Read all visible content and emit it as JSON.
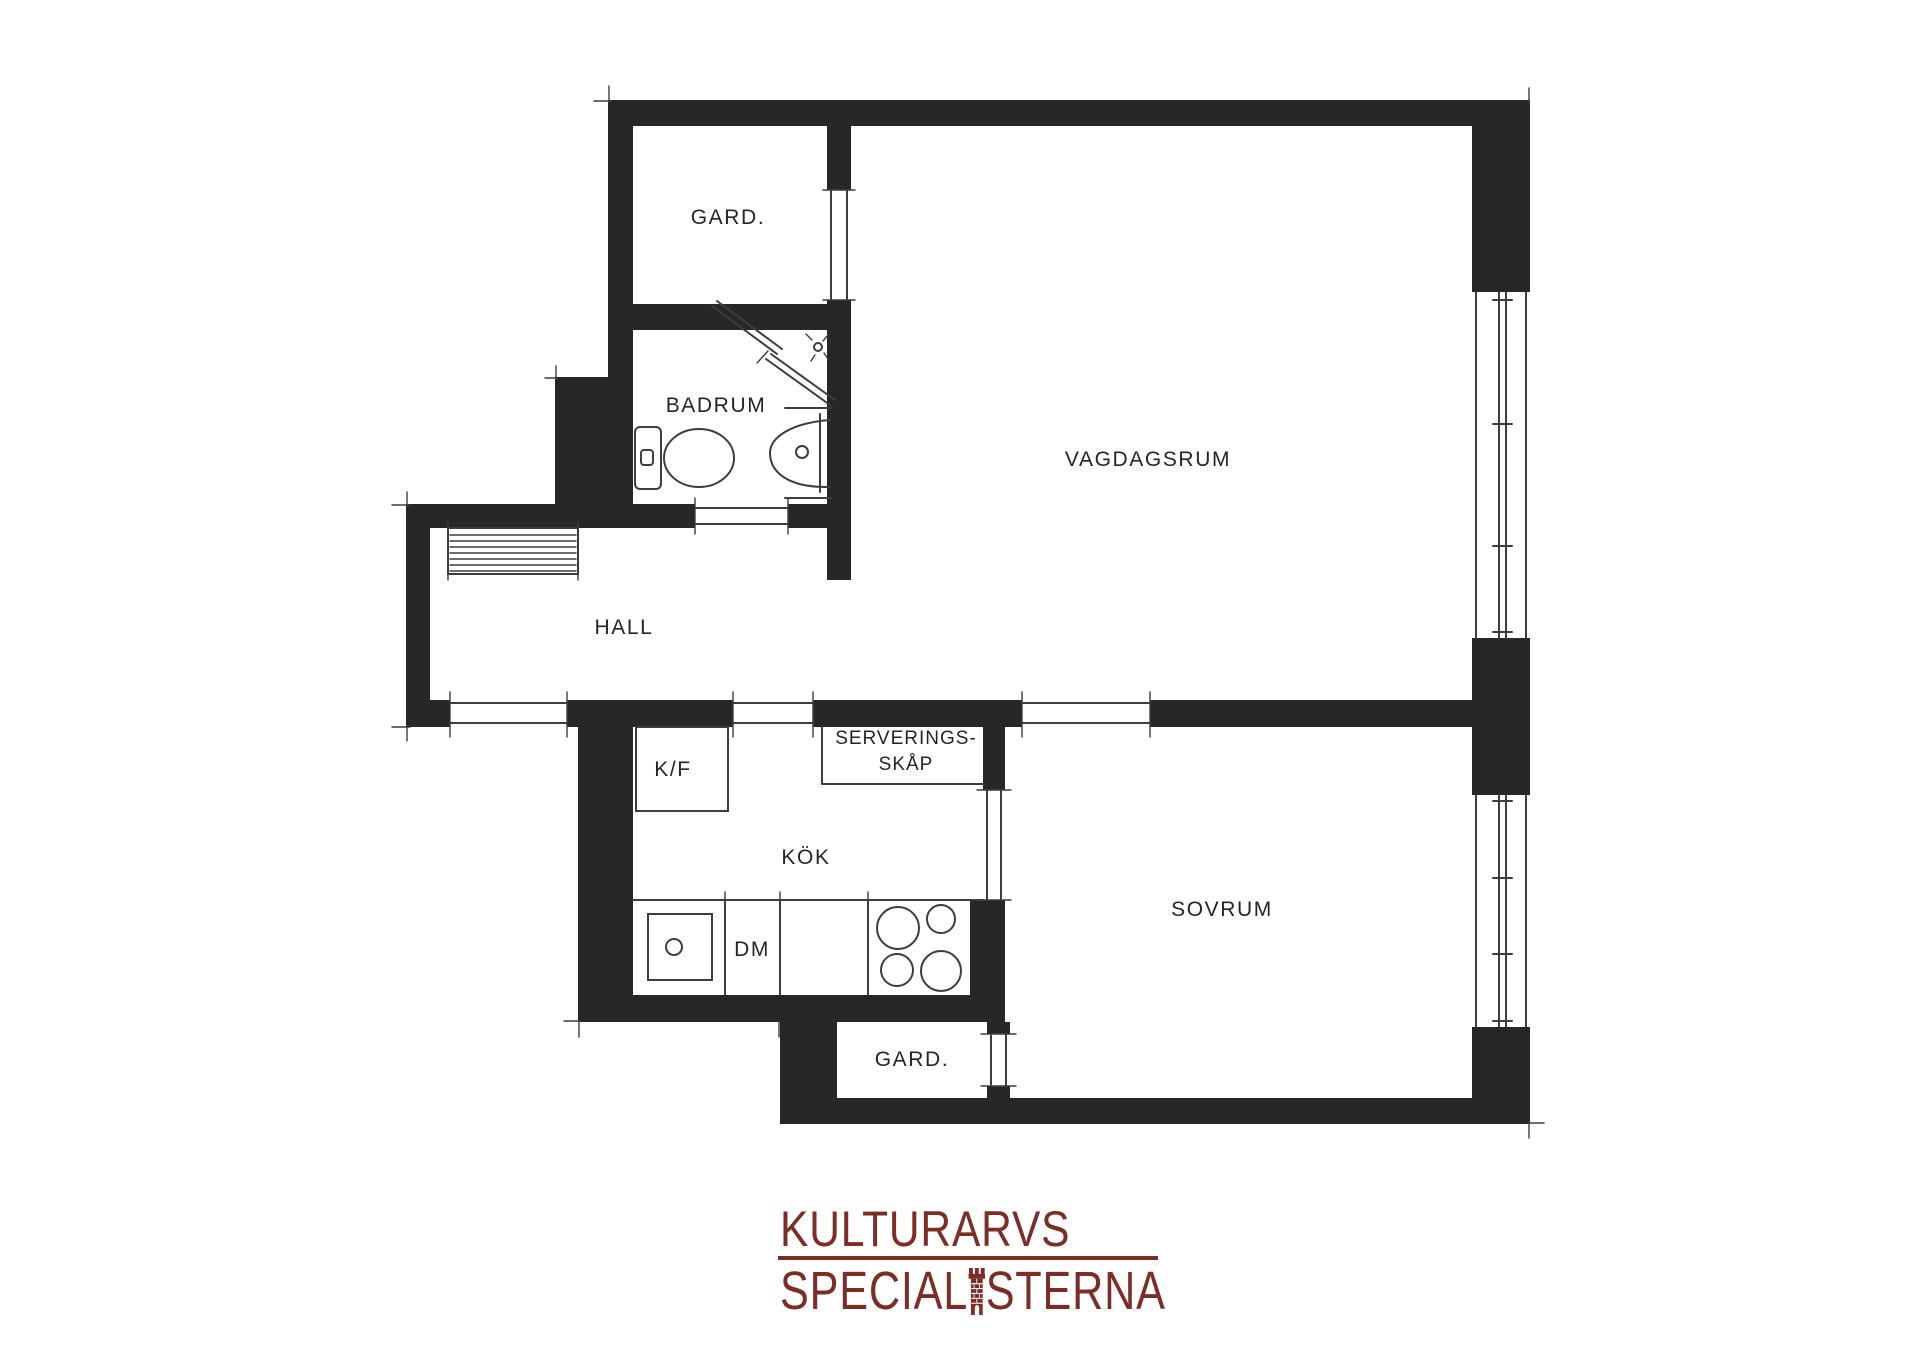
{
  "colors": {
    "wall": "#272727",
    "line": "#3d3d3d",
    "text": "#252525",
    "logo": "#7d2c26",
    "background": "#ffffff"
  },
  "plan": {
    "rooms": {
      "gard_top": {
        "label": "GARD."
      },
      "badrum": {
        "label": "BADRUM"
      },
      "vagdagsrum": {
        "label": "VAGDAGSRUM"
      },
      "hall": {
        "label": "HALL"
      },
      "serveringsskap": {
        "line1": "SERVERINGS-",
        "line2": "SKÅP"
      },
      "kok": {
        "label": "KÖK"
      },
      "sovrum": {
        "label": "SOVRUM"
      },
      "gard_bottom": {
        "label": "GARD."
      }
    },
    "appliances": {
      "fridge_freezer": {
        "label": "K/F"
      },
      "dishwasher": {
        "label": "DM"
      }
    },
    "fixtures": {
      "bathroom": [
        "toilet",
        "washbasin",
        "shower-screen",
        "shower-head"
      ],
      "hall": [
        "coat-rack"
      ],
      "kitchen": [
        "kitchen-sink",
        "dishwasher",
        "stove-4-burners",
        "fridge-freezer",
        "serving-cabinet"
      ],
      "windows": [
        "vagdagsrum-window",
        "sovrum-window"
      ],
      "openings": [
        "entrance-opening",
        "badrum-door",
        "gard-top-door",
        "hall-kok-door",
        "vagdagsrum-sovrum-door",
        "kok-sovrum-door",
        "gard-bottom-door"
      ]
    }
  },
  "logo": {
    "line1": "KULTURARVS",
    "line2_prefix": "SPECIAL",
    "line2_suffix": "STERNA",
    "tower_icon": "brick-tower-icon"
  }
}
